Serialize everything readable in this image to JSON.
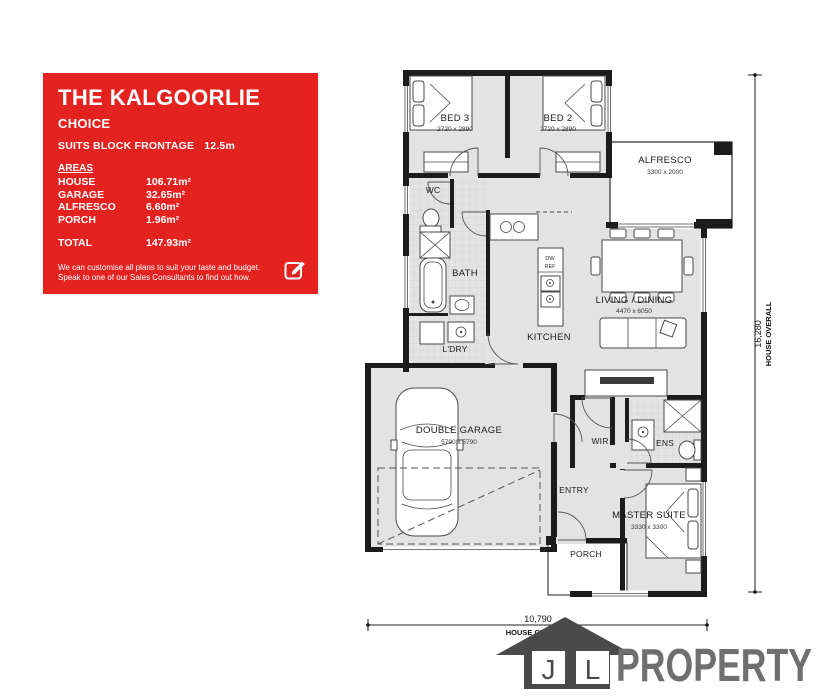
{
  "panel": {
    "title": "THE KALGOORLIE",
    "subtitle": "CHOICE",
    "frontage_label": "SUITS BLOCK FRONTAGE",
    "frontage_value": "12.5m",
    "areas_heading": "AREAS",
    "areas": [
      {
        "label": "HOUSE",
        "value": "106.71m²"
      },
      {
        "label": "GARAGE",
        "value": "32.65m²"
      },
      {
        "label": "ALFRESCO",
        "value": "6.60m²"
      },
      {
        "label": "PORCH",
        "value": "1.96m²"
      }
    ],
    "total_label": "TOTAL",
    "total_value": "147.93m²",
    "footer_line1": "We can customise all plans to suit your taste and budget.",
    "footer_line2": "Speak to one of our Sales Consultants to find out how.",
    "colors": {
      "background": "#e42320",
      "text": "#ffffff"
    }
  },
  "floorplan": {
    "rooms": {
      "bed3": {
        "name": "BED 3",
        "dims": "2720 x 2890"
      },
      "bed2": {
        "name": "BED 2",
        "dims": "2720 x 2890"
      },
      "alfresco": {
        "name": "ALFRESCO",
        "dims": "3300 x 2000"
      },
      "wc": {
        "name": "WC"
      },
      "bath": {
        "name": "BATH"
      },
      "ldry": {
        "name": "L'DRY"
      },
      "kitchen": {
        "name": "KITCHEN"
      },
      "living": {
        "name": "LIVING / DINING",
        "dims": "4470 x 6050"
      },
      "garage": {
        "name": "DOUBLE GARAGE",
        "dims": "5790 x 5790"
      },
      "entry": {
        "name": "ENTRY"
      },
      "wir": {
        "name": "WIR"
      },
      "ens": {
        "name": "ENS"
      },
      "master": {
        "name": "MASTER SUITE",
        "dims": "3330 x 3300"
      },
      "porch": {
        "name": "PORCH"
      }
    },
    "appliances": {
      "dw": "DW",
      "ref": "REF"
    },
    "dimensions": {
      "overall_height_value": "16,280",
      "overall_height_label": "HOUSE OVERALL",
      "overall_width_value": "10,790",
      "overall_width_label": "HOUSE OVERALL"
    },
    "colors": {
      "floor": "#e3e3e3",
      "wall": "#1c1c1c"
    }
  },
  "logo": {
    "initial_j": "J",
    "initial_l": "L",
    "name": "PROPERTY",
    "house_color": "#4a4a4a",
    "text_color": "#6f6f6f"
  }
}
